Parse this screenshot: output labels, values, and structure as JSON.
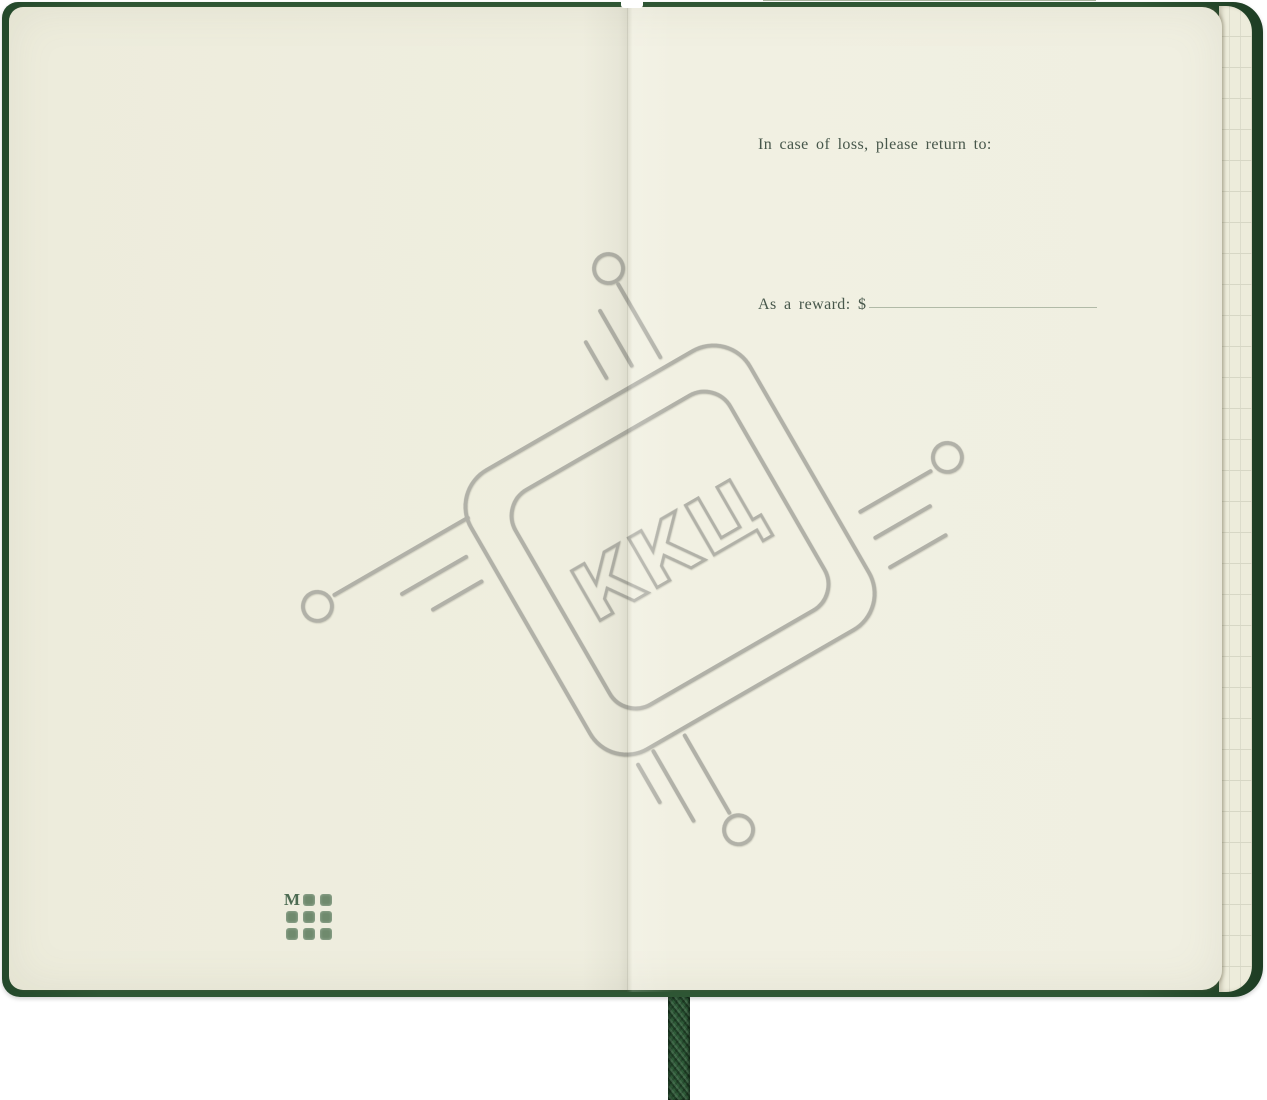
{
  "notebook": {
    "right_page": {
      "return_label": "In case of loss, please return to:",
      "address_line_count": 4,
      "reward_label": "As a reward: $"
    },
    "watermark": {
      "text": "ККЦ"
    },
    "brand_logo": {
      "letter": "M",
      "dot_rows": 3,
      "dot_cols": 3
    },
    "colors": {
      "cover_green": "#2e5634",
      "page_cream": "#efeee0",
      "squared_page_edge": "#edecdb",
      "watermark_gray": "#b1b1a8",
      "rule_line_green": "#a6b09c",
      "text_green": "#47574b",
      "logo_green": "#6f8a6d",
      "ribbon_green": "#2d5a37"
    }
  }
}
